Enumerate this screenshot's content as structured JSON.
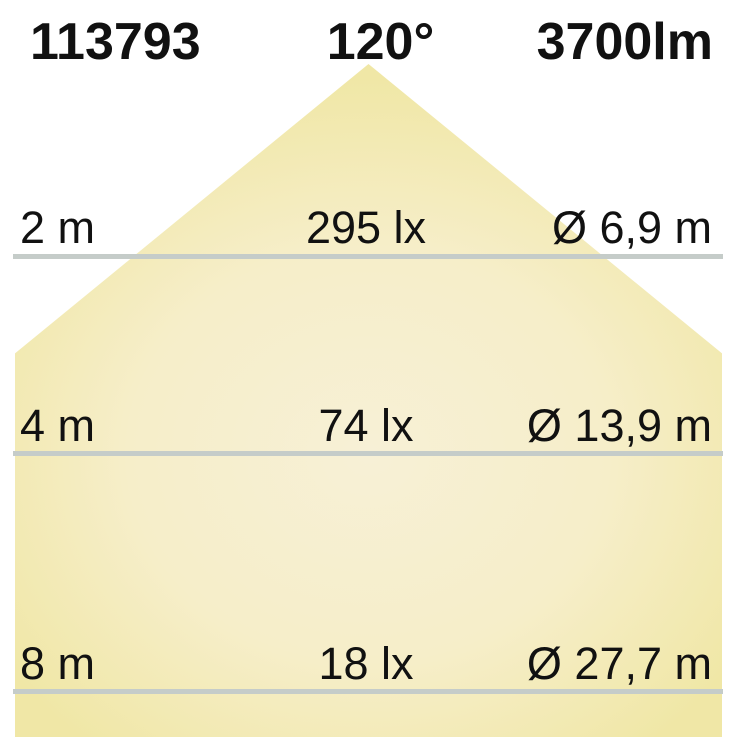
{
  "title": "Light distribution diagram",
  "header": {
    "article_number": "113793",
    "beam_angle": "120°",
    "luminous_flux": "3700lm"
  },
  "rows": [
    {
      "distance": "2 m",
      "illuminance": "295 lx",
      "diameter": "Ø 6,9 m"
    },
    {
      "distance": "4 m",
      "illuminance": "74 lx",
      "diameter": "Ø 13,9 m"
    },
    {
      "distance": "8 m",
      "illuminance": "18 lx",
      "diameter": "Ø 27,7 m"
    }
  ],
  "colors": {
    "background": "#ffffff",
    "text": "#111111",
    "line": "#c5ccc9",
    "cone_center": "#f7f0d6",
    "cone_mid": "#f6eec9",
    "cone_edge": "#f0e7a6"
  }
}
